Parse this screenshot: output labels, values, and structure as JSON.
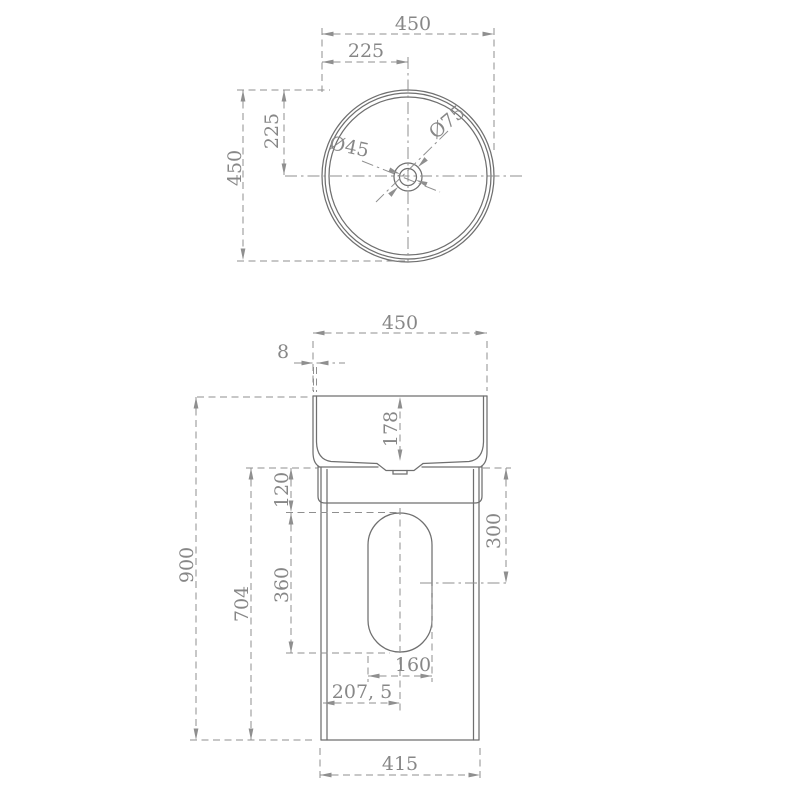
{
  "colors": {
    "background": "#ffffff",
    "object_line": "#6f6f6f",
    "dimension_line": "#8f8f8f",
    "dimension_text": "#878787"
  },
  "drawing": {
    "top_view": {
      "dims": {
        "overall_width": "450",
        "center_offset_x": "225",
        "overall_depth": "450",
        "center_offset_y": "225",
        "drain_hole_diameter": "Ø45",
        "drain_recess_diameter": "Ø75"
      }
    },
    "front_view": {
      "dims": {
        "top_width": "450",
        "rim_thickness": "8",
        "bowl_depth": "178",
        "cutout_top_offset": "120",
        "outlet_center_offset": "300",
        "overall_height": "900",
        "pedestal_height": "704",
        "cutout_height": "360",
        "cutout_width": "160",
        "cutout_center_offset": "207, 5",
        "base_width": "415"
      }
    }
  }
}
